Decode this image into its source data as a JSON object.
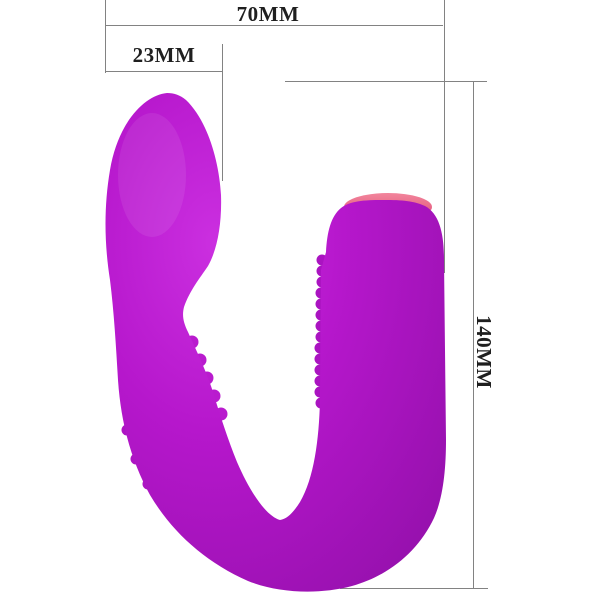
{
  "diagram": {
    "background_color": "#ffffff",
    "labels": {
      "width": "70MM",
      "head_width": "23MM",
      "height": "140MM"
    },
    "colors": {
      "product_body": "#b617cc",
      "product_highlight": "#cb2fe0",
      "product_shadow": "#9410ab",
      "cap_band_pink": "#ee6b8c",
      "dimension_line": "#828282",
      "label_text": "#1f1f1f"
    }
  }
}
